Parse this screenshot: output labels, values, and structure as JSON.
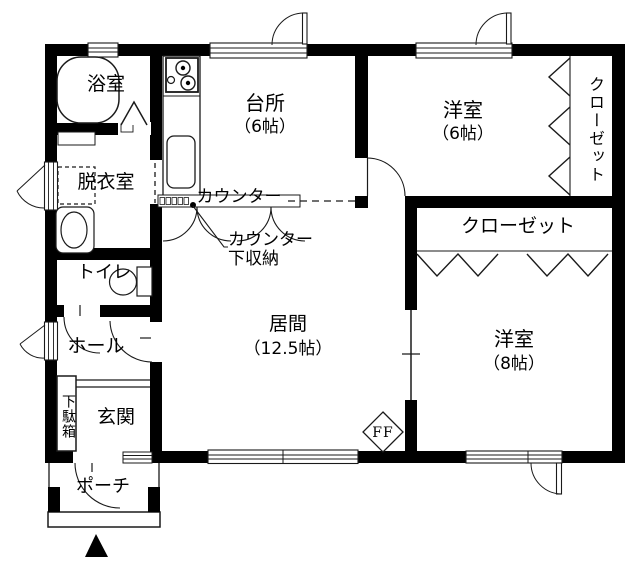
{
  "floor_plan": {
    "rooms": {
      "bathroom": {
        "name": "浴室"
      },
      "kitchen": {
        "name": "台所",
        "size": "（6帖）"
      },
      "bedroom_west": {
        "name": "洋室",
        "size": "（6帖）"
      },
      "closet_side": {
        "name": "クローゼット"
      },
      "dressing_room": {
        "name": "脱衣室"
      },
      "toilet": {
        "name": "トイレ"
      },
      "hall": {
        "name": "ホール"
      },
      "living_room": {
        "name": "居間",
        "size": "（12.5帖）"
      },
      "closet_main": {
        "name": "クローゼット"
      },
      "bedroom_east": {
        "name": "洋室",
        "size": "（8帖）"
      },
      "entrance": {
        "name": "玄関"
      },
      "shoe_cabinet": {
        "name": "下駄箱"
      },
      "porch": {
        "name": "ポーチ"
      }
    },
    "annotations": {
      "counter": "カウンター",
      "under_counter_storage": [
        "カウンター",
        "下収納"
      ],
      "ff_heater": "FF"
    },
    "colors": {
      "wall": "#000000",
      "line": "#1a1a1a",
      "background": "#ffffff"
    }
  }
}
